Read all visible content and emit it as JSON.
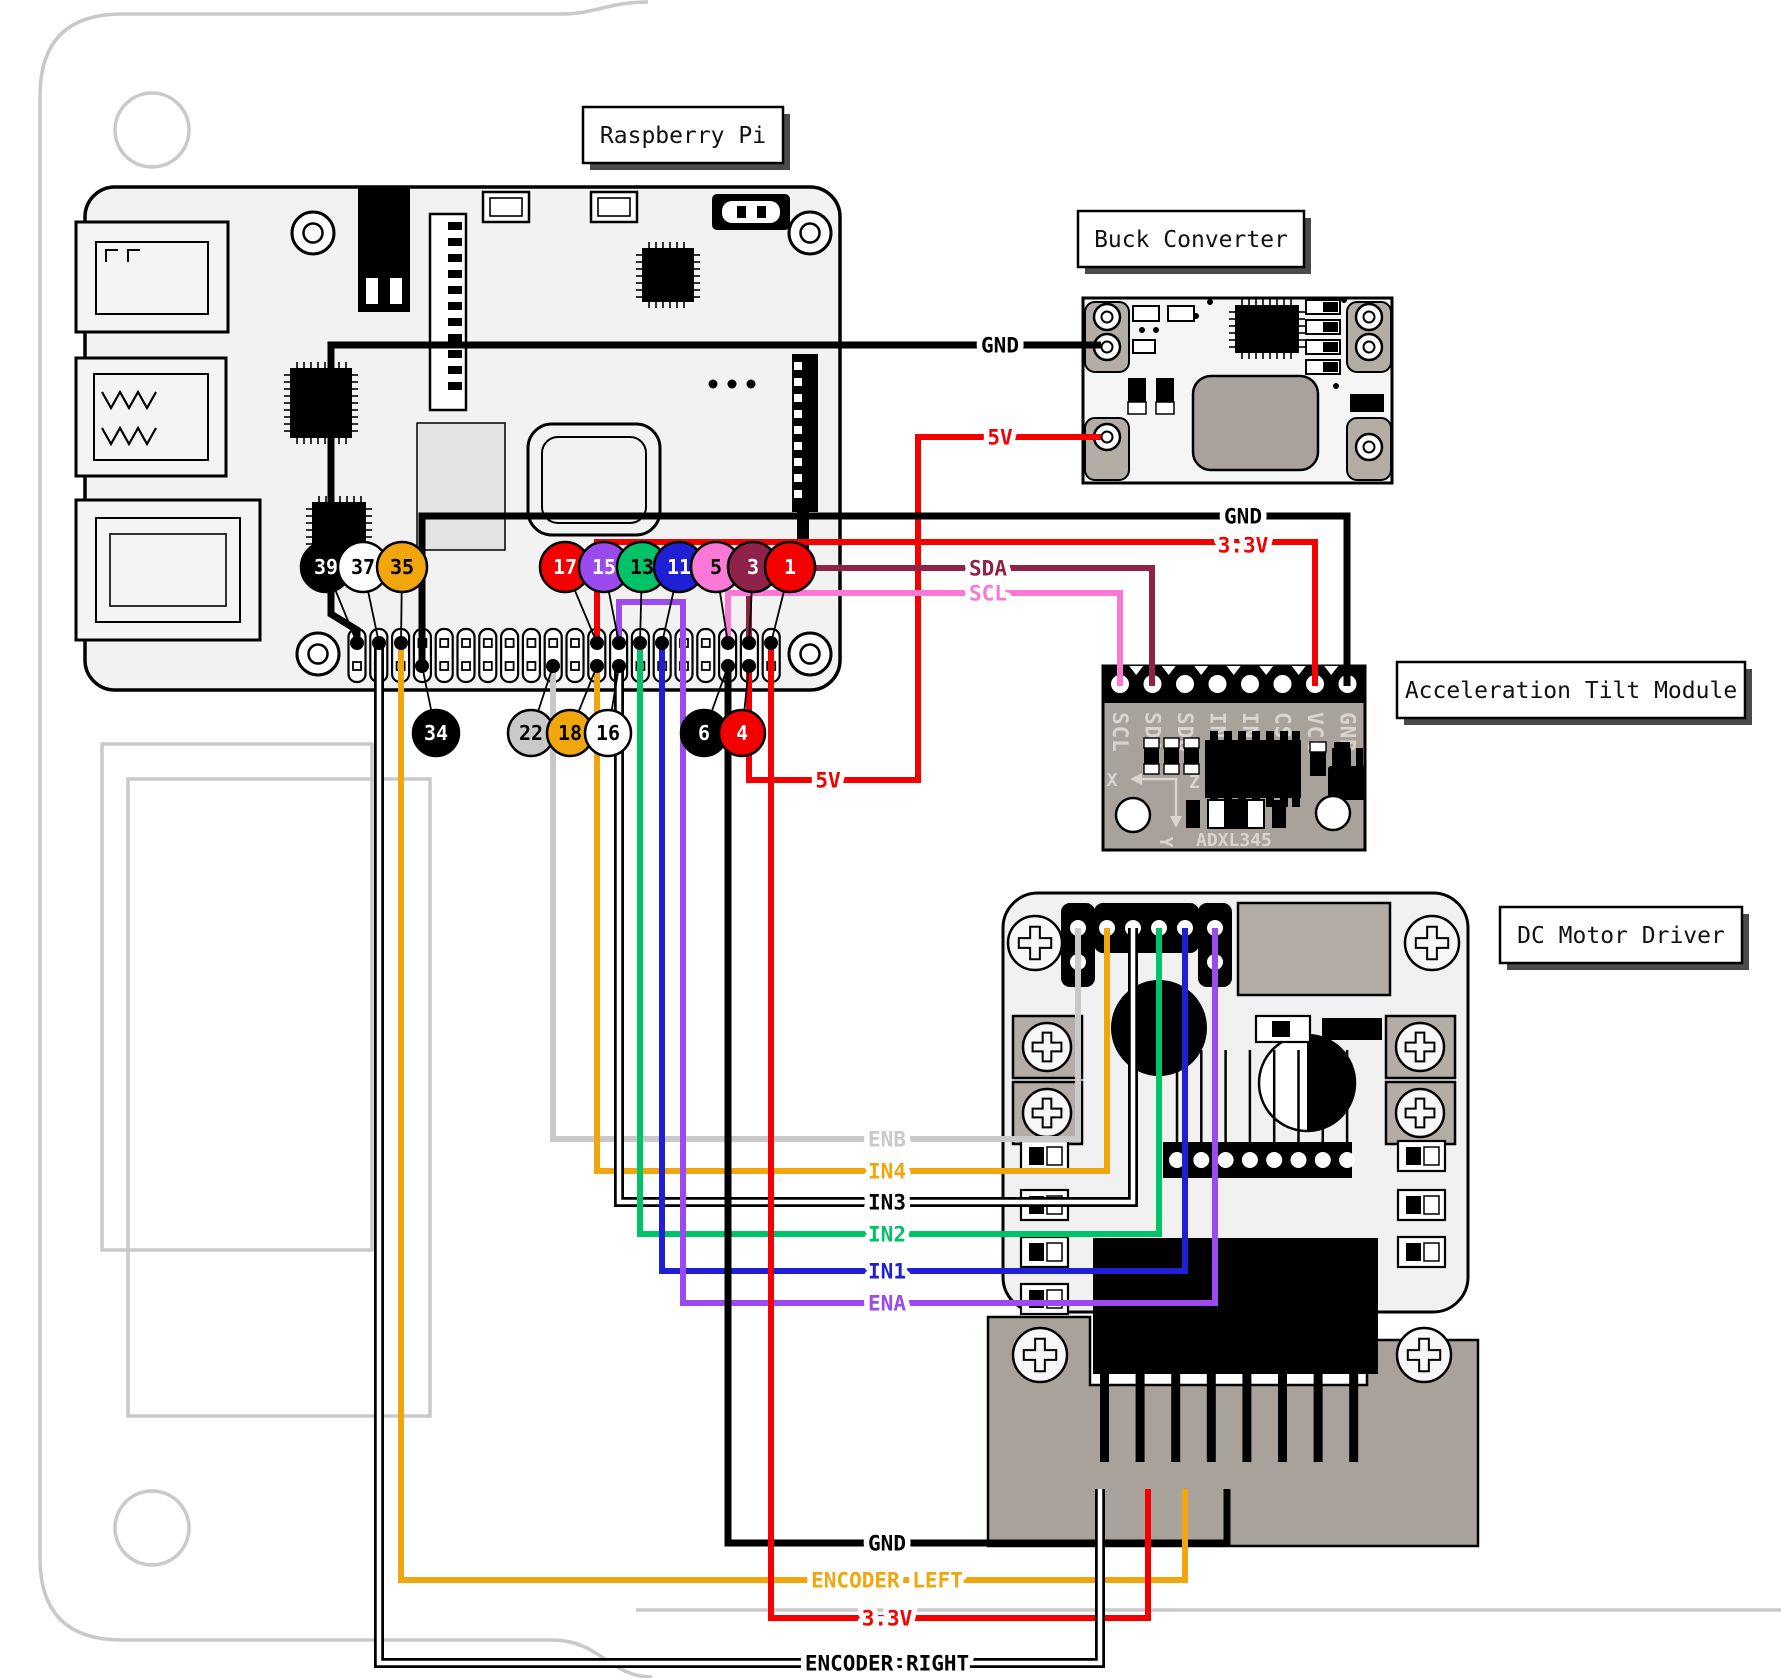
{
  "title_boxes": [
    {
      "id": "raspberry-pi-label",
      "text": "Raspberry Pi",
      "x": 583,
      "y": 107,
      "w": 200,
      "h": 56
    },
    {
      "id": "buck-converter-label",
      "text": "Buck Converter",
      "x": 1078,
      "y": 211,
      "w": 226,
      "h": 56
    },
    {
      "id": "acceleration-tilt-module-label",
      "text": "Acceleration Tilt Module",
      "x": 1397,
      "y": 662,
      "w": 348,
      "h": 56
    },
    {
      "id": "dc-motor-driver-label",
      "text": "DC Motor Driver",
      "x": 1500,
      "y": 907,
      "w": 242,
      "h": 56
    }
  ],
  "pi": {
    "pin_circles": [
      {
        "n": "39",
        "x": 326,
        "y": 567,
        "r": 25,
        "fill": "#000000",
        "text": "#ffffff",
        "dot": [
          357,
          643
        ]
      },
      {
        "n": "37",
        "x": 363,
        "y": 567,
        "r": 25,
        "fill": "#ffffff",
        "text": "#000000",
        "dot": [
          379,
          643
        ]
      },
      {
        "n": "35",
        "x": 402,
        "y": 567,
        "r": 25,
        "fill": "#f2a60d",
        "text": "#000000",
        "dot": [
          401,
          643
        ]
      },
      {
        "n": "17",
        "x": 565,
        "y": 567,
        "r": 25,
        "fill": "#f40000",
        "text": "#ffffff",
        "dot": [
          597,
          643
        ]
      },
      {
        "n": "15",
        "x": 604,
        "y": 567,
        "r": 25,
        "fill": "#9b4af0",
        "text": "#ffffff",
        "dot": [
          619,
          643
        ]
      },
      {
        "n": "13",
        "x": 642,
        "y": 567,
        "r": 25,
        "fill": "#00c266",
        "text": "#000000",
        "dot": [
          640,
          643
        ]
      },
      {
        "n": "11",
        "x": 679,
        "y": 567,
        "r": 25,
        "fill": "#1f1fd6",
        "text": "#ffffff",
        "dot": [
          662,
          643
        ]
      },
      {
        "n": "5",
        "x": 716,
        "y": 567,
        "r": 25,
        "fill": "#fb78d7",
        "text": "#000000",
        "dot": [
          728,
          643
        ]
      },
      {
        "n": "3",
        "x": 753,
        "y": 567,
        "r": 25,
        "fill": "#8f2248",
        "text": "#ffffff",
        "dot": [
          749,
          643
        ]
      },
      {
        "n": "1",
        "x": 790,
        "y": 567,
        "r": 25,
        "fill": "#f40000",
        "text": "#ffffff",
        "dot": [
          771,
          643
        ]
      },
      {
        "n": "34",
        "x": 436,
        "y": 733,
        "r": 23,
        "fill": "#000000",
        "text": "#ffffff",
        "dot": [
          422,
          666
        ]
      },
      {
        "n": "22",
        "x": 531,
        "y": 733,
        "r": 23,
        "fill": "#c9c9c9",
        "text": "#000000",
        "dot": [
          553,
          666
        ]
      },
      {
        "n": "18",
        "x": 570,
        "y": 733,
        "r": 23,
        "fill": "#f2a60d",
        "text": "#000000",
        "dot": [
          597,
          666
        ]
      },
      {
        "n": "16",
        "x": 608,
        "y": 733,
        "r": 23,
        "fill": "#ffffff",
        "text": "#000000",
        "dot": [
          619,
          666
        ]
      },
      {
        "n": "6",
        "x": 704,
        "y": 733,
        "r": 23,
        "fill": "#000000",
        "text": "#ffffff",
        "dot": [
          728,
          666
        ]
      },
      {
        "n": "4",
        "x": 742,
        "y": 733,
        "r": 23,
        "fill": "#f40000",
        "text": "#ffffff",
        "dot": [
          749,
          666
        ]
      }
    ]
  },
  "tilt": {
    "pin_labels": [
      "SCL",
      "SDA",
      "SDO",
      "INT2",
      "INT1",
      "CS",
      "VCC",
      "GND"
    ],
    "chip_label": "ADXL345",
    "axis": [
      "X",
      "Z",
      "Y"
    ]
  },
  "wires": [
    {
      "name": "gnd-to-buck-wire",
      "color": "#000000",
      "w": 7,
      "pts": [
        [
          357,
          643
        ],
        [
          357,
          630
        ],
        [
          331,
          614
        ],
        [
          331,
          345
        ],
        [
          1101,
          345
        ]
      ]
    },
    {
      "name": "5v-to-buck-wire",
      "color": "#f40000",
      "w": 6,
      "pts": [
        [
          749,
          666
        ],
        [
          749,
          780
        ],
        [
          918,
          780
        ],
        [
          918,
          437
        ],
        [
          1101,
          437
        ]
      ]
    },
    {
      "name": "gnd-to-tilt-wire",
      "color": "#000000",
      "w": 7,
      "pts": [
        [
          422,
          666
        ],
        [
          422,
          516
        ],
        [
          1347,
          516
        ],
        [
          1347,
          686
        ]
      ]
    },
    {
      "name": "3v3-to-tilt-wire",
      "color": "#f40000",
      "w": 6,
      "pts": [
        [
          597,
          643
        ],
        [
          597,
          542
        ],
        [
          1315,
          542
        ],
        [
          1315,
          686
        ]
      ]
    },
    {
      "name": "sda-wire",
      "color": "#8f2248",
      "w": 6,
      "pts": [
        [
          749,
          643
        ],
        [
          749,
          568
        ],
        [
          1152,
          568
        ],
        [
          1152,
          686
        ]
      ]
    },
    {
      "name": "scl-wire",
      "color": "#fb78d7",
      "w": 6,
      "pts": [
        [
          728,
          643
        ],
        [
          728,
          593
        ],
        [
          1120,
          593
        ],
        [
          1120,
          686
        ]
      ]
    },
    {
      "name": "enb-wire",
      "color": "#c9c9c9",
      "w": 6,
      "pts": [
        [
          553,
          666
        ],
        [
          553,
          1139
        ],
        [
          1078,
          1139
        ],
        [
          1078,
          928
        ]
      ]
    },
    {
      "name": "in4-wire",
      "color": "#f2a60d",
      "w": 6,
      "pts": [
        [
          597,
          666
        ],
        [
          597,
          1171
        ],
        [
          1107,
          1171
        ],
        [
          1107,
          928
        ]
      ]
    },
    {
      "name": "in3-wire",
      "white": true,
      "w": 6,
      "pts": [
        [
          619,
          666
        ],
        [
          619,
          1202
        ],
        [
          1133,
          1202
        ],
        [
          1133,
          928
        ]
      ]
    },
    {
      "name": "in2-wire",
      "color": "#00c266",
      "w": 6,
      "pts": [
        [
          640,
          643
        ],
        [
          640,
          1234
        ],
        [
          1159,
          1234
        ],
        [
          1159,
          928
        ]
      ]
    },
    {
      "name": "in1-wire",
      "color": "#1f1fd6",
      "w": 6,
      "pts": [
        [
          662,
          643
        ],
        [
          662,
          1271
        ],
        [
          1185,
          1271
        ],
        [
          1185,
          928
        ]
      ]
    },
    {
      "name": "ena-wire",
      "color": "#9b4af0",
      "w": 6,
      "pts": [
        [
          619,
          643
        ],
        [
          619,
          602
        ],
        [
          683,
          602
        ],
        [
          683,
          1303
        ],
        [
          1215,
          1303
        ],
        [
          1215,
          928
        ]
      ]
    },
    {
      "name": "gnd-to-motor-wire",
      "color": "#000000",
      "w": 7,
      "pts": [
        [
          728,
          666
        ],
        [
          728,
          1543
        ],
        [
          1227,
          1543
        ],
        [
          1227,
          1489
        ]
      ]
    },
    {
      "name": "encoder-left-wire",
      "color": "#f2a60d",
      "w": 6,
      "pts": [
        [
          401,
          643
        ],
        [
          401,
          1580
        ],
        [
          1185,
          1580
        ],
        [
          1185,
          1489
        ]
      ]
    },
    {
      "name": "3v3-to-motor-wire",
      "color": "#f40000",
      "w": 6,
      "pts": [
        [
          771,
          643
        ],
        [
          771,
          1618
        ],
        [
          1148,
          1618
        ],
        [
          1148,
          1489
        ]
      ]
    },
    {
      "name": "encoder-right-wire",
      "white": true,
      "w": 6,
      "pts": [
        [
          379,
          643
        ],
        [
          379,
          1663
        ],
        [
          1100,
          1663
        ],
        [
          1100,
          1489
        ]
      ]
    }
  ],
  "wire_labels": [
    {
      "text": "GND",
      "x": 1000,
      "y": 345,
      "color": "#000000"
    },
    {
      "text": "5V",
      "x": 1000,
      "y": 437,
      "color": "#f40000"
    },
    {
      "text": "GND",
      "x": 1243,
      "y": 516,
      "color": "#000000"
    },
    {
      "text": "3.3V",
      "x": 1243,
      "y": 545,
      "color": "#f40000"
    },
    {
      "text": "SDA",
      "x": 988,
      "y": 568,
      "color": "#8f2248"
    },
    {
      "text": "SCL",
      "x": 988,
      "y": 593,
      "color": "#fb78d7"
    },
    {
      "text": "5V",
      "x": 828,
      "y": 780,
      "color": "#f40000"
    },
    {
      "text": "ENB",
      "x": 887,
      "y": 1139,
      "color": "#c9c9c9"
    },
    {
      "text": "IN4",
      "x": 887,
      "y": 1171,
      "color": "#f2a60d"
    },
    {
      "text": "IN3",
      "x": 887,
      "y": 1202,
      "color": "#000000"
    },
    {
      "text": "IN2",
      "x": 887,
      "y": 1234,
      "color": "#00c266"
    },
    {
      "text": "IN1",
      "x": 887,
      "y": 1271,
      "color": "#1f1fd6"
    },
    {
      "text": "ENA",
      "x": 887,
      "y": 1303,
      "color": "#9b4af0"
    },
    {
      "text": "GND",
      "x": 887,
      "y": 1543,
      "color": "#000000"
    },
    {
      "text": "ENCODER LEFT",
      "x": 887,
      "y": 1580,
      "color": "#f2a60d"
    },
    {
      "text": "3.3V",
      "x": 887,
      "y": 1618,
      "color": "#f40000"
    },
    {
      "text": "ENCODER RIGHT",
      "x": 887,
      "y": 1663,
      "color": "#000000"
    }
  ],
  "colors": {
    "chassis": "#c9c9c9",
    "pcb_light": "#f2f2f2",
    "module_gray": "#a9a29a",
    "pad_gray": "#b3ada6",
    "red": "#f40000",
    "orange": "#f2a60d",
    "green": "#00c266",
    "blue": "#1f1fd6",
    "purple": "#9b4af0",
    "pink": "#fb78d7",
    "maroon": "#8f2248",
    "gray_wire": "#c9c9c9",
    "black": "#000000",
    "white": "#ffffff"
  }
}
